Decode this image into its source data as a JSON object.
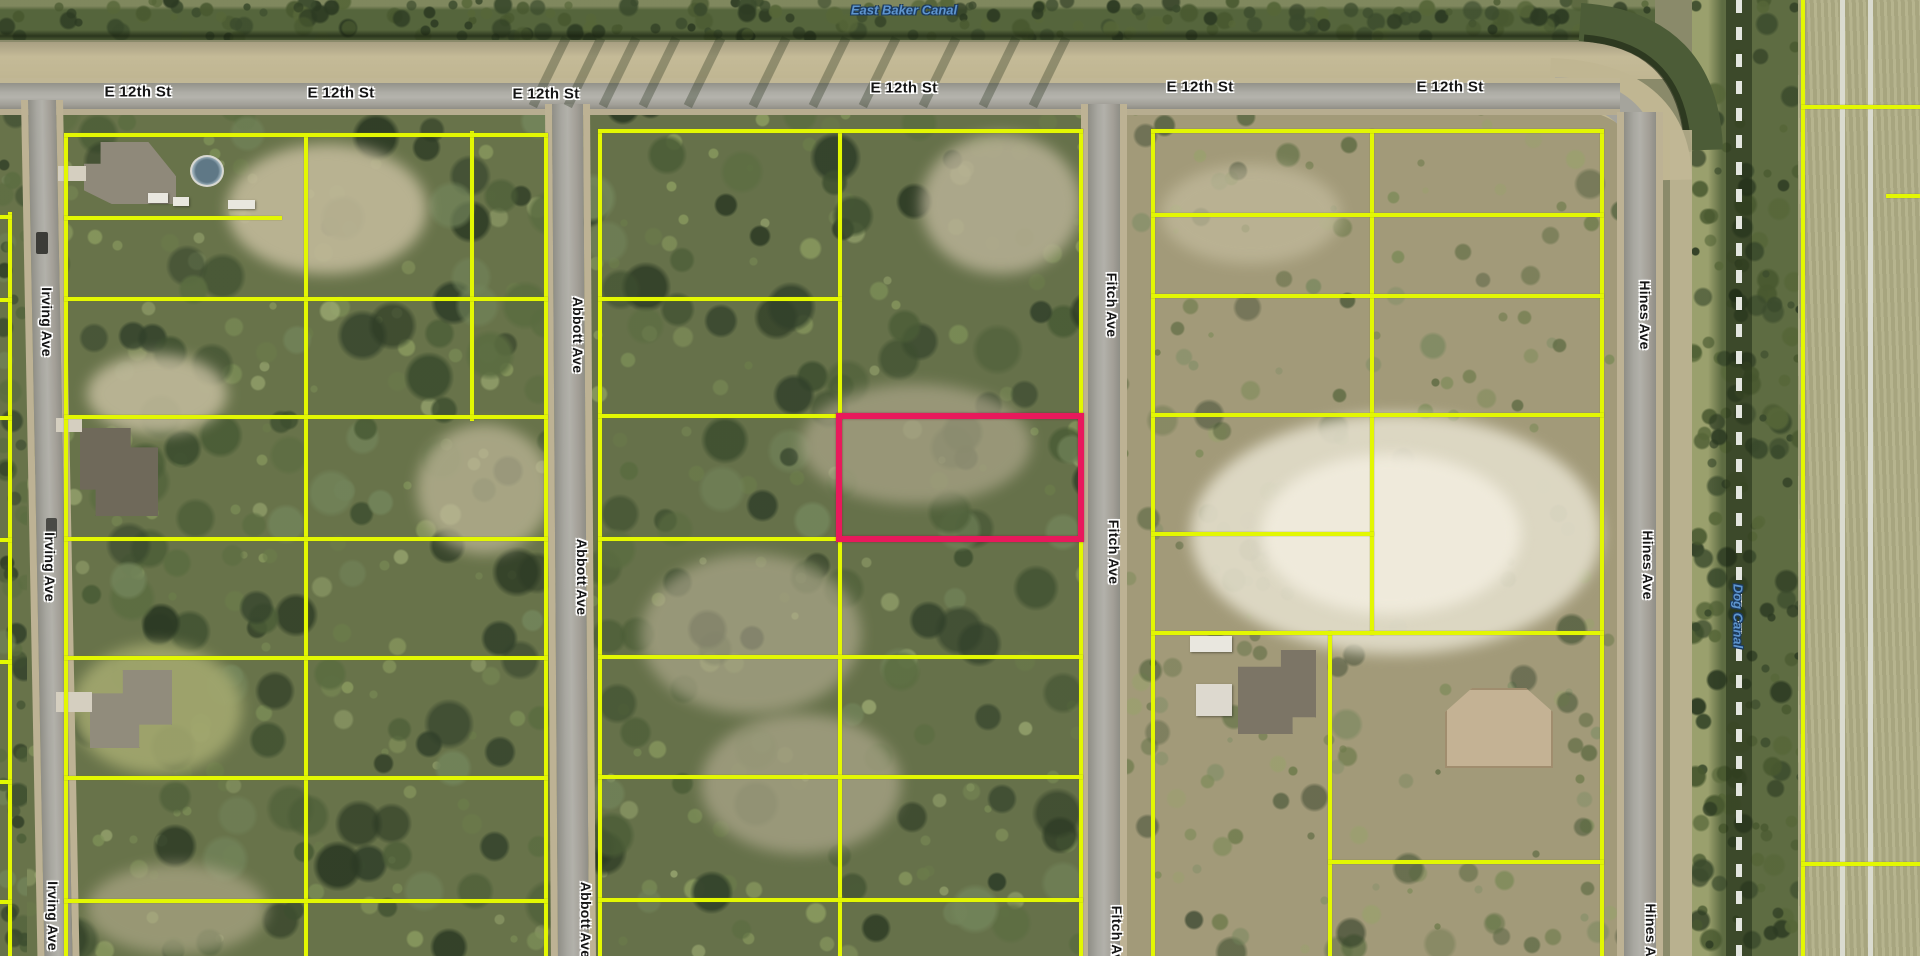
{
  "map": {
    "type": "aerial-parcel-map",
    "streets": [
      "E 12th St",
      "Irving Ave",
      "Abbott Ave",
      "Fitch Ave",
      "Hines Ave"
    ],
    "waterways": [
      "East Baker Canal",
      "Dog Canal"
    ],
    "highlighted_parcel": {
      "outline_color": "#e8195c",
      "x": 836,
      "y": 413,
      "width": 248,
      "height": 129
    },
    "colors": {
      "parcel_line": "#e3f702",
      "highlight_outline": "#e8195c",
      "street_label_text": "#151515",
      "street_label_halo": "#ffffff",
      "water_label_text": "#5e95cf"
    },
    "labels": [
      {
        "text": "East Baker Canal",
        "x": 904,
        "y": 10,
        "orient": "h",
        "kind": "water"
      },
      {
        "text": "E 12th St",
        "x": 138,
        "y": 92,
        "orient": "h",
        "kind": "street"
      },
      {
        "text": "E 12th St",
        "x": 341,
        "y": 93,
        "orient": "h",
        "kind": "street"
      },
      {
        "text": "E 12th St",
        "x": 546,
        "y": 94,
        "orient": "h",
        "kind": "street"
      },
      {
        "text": "E 12th St",
        "x": 904,
        "y": 88,
        "orient": "h",
        "kind": "street"
      },
      {
        "text": "E 12th St",
        "x": 1200,
        "y": 87,
        "orient": "h",
        "kind": "street"
      },
      {
        "text": "E 12th St",
        "x": 1450,
        "y": 87,
        "orient": "h",
        "kind": "street"
      },
      {
        "text": "Irving Ave",
        "x": 47,
        "y": 322,
        "orient": "v",
        "kind": "street"
      },
      {
        "text": "Irving Ave",
        "x": 50,
        "y": 567,
        "orient": "v",
        "kind": "street"
      },
      {
        "text": "Irving Ave",
        "x": 53,
        "y": 916,
        "orient": "v",
        "kind": "street"
      },
      {
        "text": "Abbott Ave",
        "x": 578,
        "y": 335,
        "orient": "v",
        "kind": "street"
      },
      {
        "text": "Abbott Ave",
        "x": 582,
        "y": 577,
        "orient": "v",
        "kind": "street"
      },
      {
        "text": "Abbott Ave",
        "x": 586,
        "y": 920,
        "orient": "v",
        "kind": "street"
      },
      {
        "text": "Fitch Ave",
        "x": 1112,
        "y": 305,
        "orient": "v",
        "kind": "street"
      },
      {
        "text": "Fitch Ave",
        "x": 1114,
        "y": 552,
        "orient": "v",
        "kind": "street"
      },
      {
        "text": "Fitch Ave",
        "x": 1117,
        "y": 938,
        "orient": "v",
        "kind": "street"
      },
      {
        "text": "Hines Ave",
        "x": 1645,
        "y": 315,
        "orient": "v",
        "kind": "street"
      },
      {
        "text": "Hines Ave",
        "x": 1648,
        "y": 565,
        "orient": "v",
        "kind": "street"
      },
      {
        "text": "Hines Ave",
        "x": 1651,
        "y": 938,
        "orient": "v",
        "kind": "street"
      },
      {
        "text": "Dog Canal",
        "x": 1738,
        "y": 616,
        "orient": "v",
        "kind": "water"
      }
    ],
    "parcel_lines": {
      "vertical": [
        {
          "x": 8,
          "y": 212,
          "h": 744
        },
        {
          "x": 64,
          "y": 133,
          "h": 823
        },
        {
          "x": 304,
          "y": 133,
          "h": 823
        },
        {
          "x": 470,
          "y": 131,
          "h": 290
        },
        {
          "x": 544,
          "y": 133,
          "h": 823
        },
        {
          "x": 598,
          "y": 129,
          "h": 827
        },
        {
          "x": 838,
          "y": 129,
          "h": 827
        },
        {
          "x": 1079,
          "y": 129,
          "h": 827
        },
        {
          "x": 1151,
          "y": 129,
          "h": 827
        },
        {
          "x": 1370,
          "y": 129,
          "h": 506
        },
        {
          "x": 1328,
          "y": 631,
          "h": 325
        },
        {
          "x": 1600,
          "y": 129,
          "h": 827
        },
        {
          "x": 1801,
          "y": 0,
          "h": 956
        }
      ],
      "horizontal": [
        {
          "x": 0,
          "y": 215,
          "w": 12
        },
        {
          "x": 0,
          "y": 298,
          "w": 12
        },
        {
          "x": 0,
          "y": 416,
          "w": 12
        },
        {
          "x": 0,
          "y": 538,
          "w": 12
        },
        {
          "x": 0,
          "y": 660,
          "w": 12
        },
        {
          "x": 0,
          "y": 780,
          "w": 12
        },
        {
          "x": 0,
          "y": 900,
          "w": 12
        },
        {
          "x": 64,
          "y": 133,
          "w": 484
        },
        {
          "x": 64,
          "y": 216,
          "w": 218
        },
        {
          "x": 64,
          "y": 297,
          "w": 484
        },
        {
          "x": 64,
          "y": 415,
          "w": 484
        },
        {
          "x": 64,
          "y": 537,
          "w": 484
        },
        {
          "x": 64,
          "y": 656,
          "w": 484
        },
        {
          "x": 64,
          "y": 776,
          "w": 484
        },
        {
          "x": 64,
          "y": 899,
          "w": 484
        },
        {
          "x": 598,
          "y": 129,
          "w": 485
        },
        {
          "x": 598,
          "y": 297,
          "w": 244
        },
        {
          "x": 598,
          "y": 414,
          "w": 244
        },
        {
          "x": 598,
          "y": 537,
          "w": 244
        },
        {
          "x": 598,
          "y": 655,
          "w": 485
        },
        {
          "x": 598,
          "y": 775,
          "w": 485
        },
        {
          "x": 598,
          "y": 898,
          "w": 485
        },
        {
          "x": 1151,
          "y": 129,
          "w": 453
        },
        {
          "x": 1151,
          "y": 213,
          "w": 453
        },
        {
          "x": 1151,
          "y": 294,
          "w": 453
        },
        {
          "x": 1151,
          "y": 413,
          "w": 453
        },
        {
          "x": 1151,
          "y": 532,
          "w": 223
        },
        {
          "x": 1151,
          "y": 631,
          "w": 453
        },
        {
          "x": 1328,
          "y": 860,
          "w": 276
        },
        {
          "x": 1801,
          "y": 105,
          "w": 119
        },
        {
          "x": 1886,
          "y": 194,
          "w": 34
        },
        {
          "x": 1801,
          "y": 862,
          "w": 119
        }
      ]
    }
  }
}
